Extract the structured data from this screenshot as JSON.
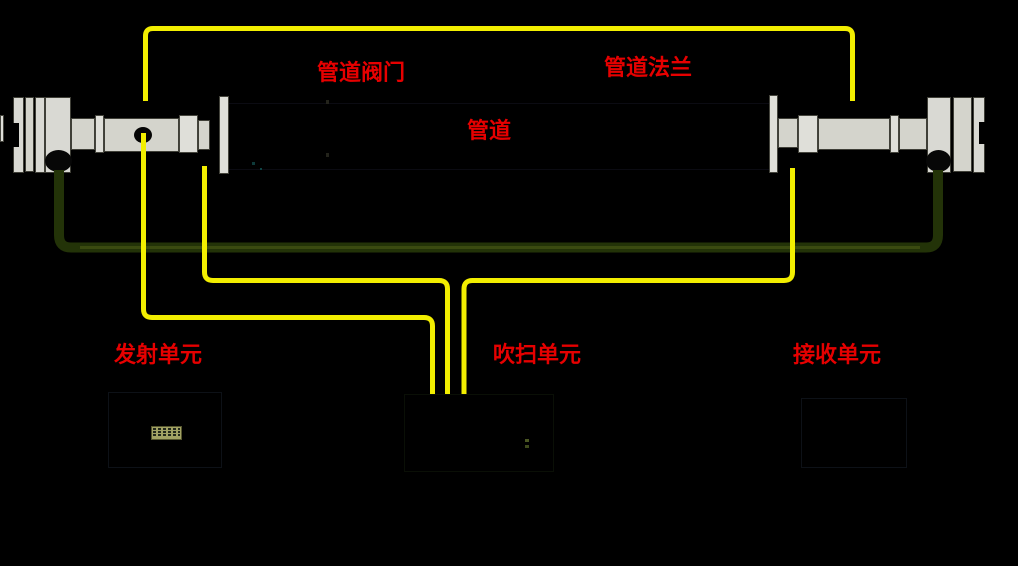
{
  "diagram": {
    "background": "#000000",
    "labels": {
      "pipe_valve": "管道阀门",
      "pipe_flange": "管道法兰",
      "pipe": "管道",
      "transmitter_unit": "发射单元",
      "purge_unit": "吹扫单元",
      "receiver_unit": "接收单元"
    },
    "colors": {
      "label_text": "#e60000",
      "purge_tube": "#f2ee00",
      "signal_cable": "#233308",
      "signal_cable_core": "#3a4a10",
      "metal_body": "#d6d6d0"
    }
  }
}
